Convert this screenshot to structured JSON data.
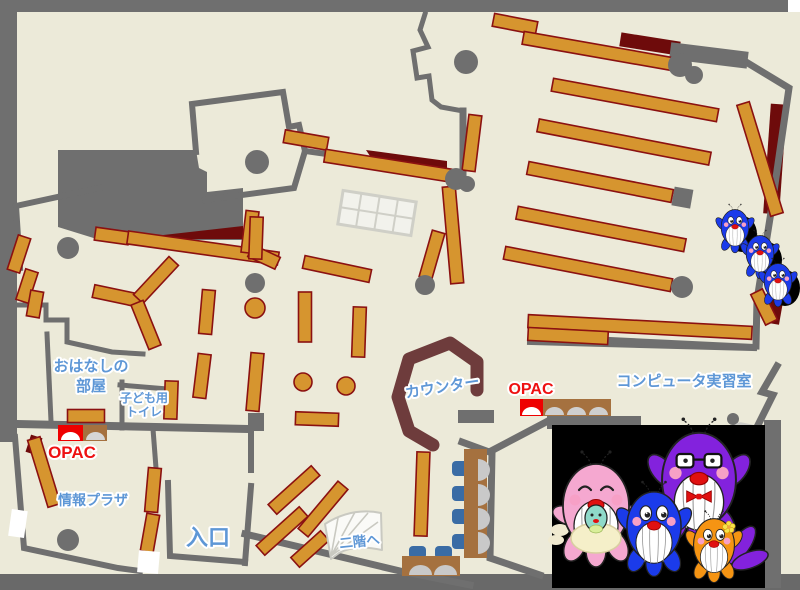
{
  "map_title": "library-first-floor-map",
  "labels": {
    "storytelling_1": "おはなしの",
    "storytelling_2": "部屋",
    "toilet_1": "子ども用",
    "toilet_2": "トイレ",
    "info_plaza": "情報プラザ",
    "entrance": "入口",
    "to_second_floor": "二階へ",
    "counter": "カウンター",
    "opac_left": "OPAC",
    "opac_right": "OPAC",
    "computer_room": "コンピュータ実習室"
  },
  "palette": {
    "floor": "#ecead9",
    "wall": "#6f6f6f",
    "bottom_band": "#696969",
    "shelf": "#d6952f",
    "shelf_border": "#8b1111",
    "maroon": "#6e0b0b",
    "counter_brown": "#6e3c3c",
    "opac_red": "#ee0000",
    "desk_brown": "#a5713f",
    "chair_blue": "#3a6ca5",
    "monitor_gray": "#c9c9c9",
    "label_blue": "#5e97d6",
    "label_red": "#ee1111",
    "mascot_pink": "#f5a8d0",
    "mascot_blue": "#1b3bea",
    "mascot_purple": "#8322dd",
    "mascot_orange": "#f59413",
    "mascot_teal": "#8fd9c9",
    "photo_background": "#000000"
  }
}
